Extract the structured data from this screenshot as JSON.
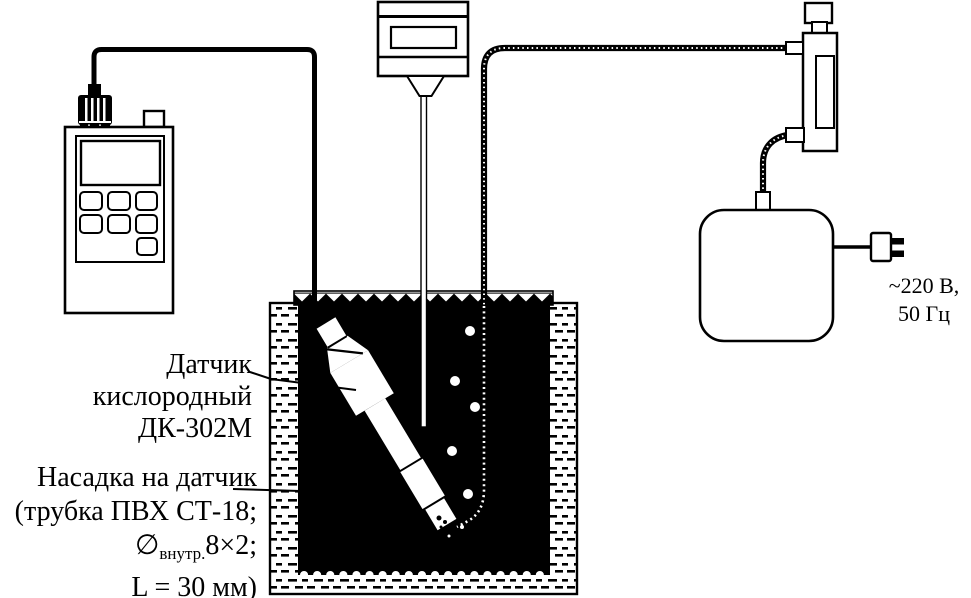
{
  "labels": {
    "sensor": {
      "line1": "Датчик",
      "line2": "кислородный",
      "line3": "ДК-302М"
    },
    "nozzle": {
      "line1": "Насадка на датчик",
      "line2": "(трубка ПВХ СТ-18;",
      "diameter_symbol": "∅",
      "diameter_subscript": "внутр.",
      "diameter_value": "8×2;",
      "line4": "L = 30 мм)"
    },
    "power_supply": {
      "line1": "~220 В,",
      "line2": "50 Гц"
    }
  },
  "colors": {
    "ink": "#000000",
    "paper": "#ffffff"
  }
}
